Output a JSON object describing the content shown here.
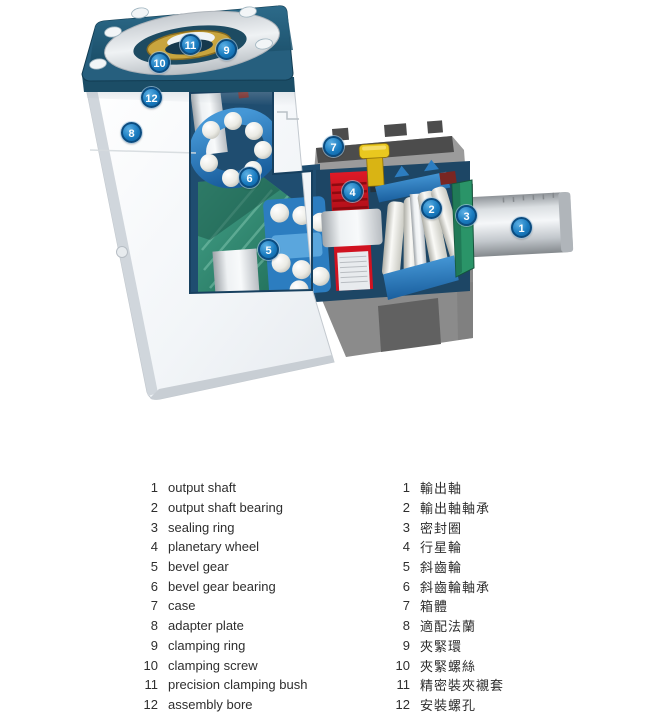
{
  "figure": {
    "type": "technical cutaway diagram",
    "subject": "right-angle planetary gearbox cross-section",
    "callouts": [
      "1",
      "2",
      "3",
      "4",
      "5",
      "6",
      "7",
      "8",
      "9",
      "10",
      "11",
      "12"
    ]
  },
  "legend": {
    "en": [
      {
        "n": "1",
        "t": "output shaft"
      },
      {
        "n": "2",
        "t": "output shaft bearing"
      },
      {
        "n": "3",
        "t": "sealing ring"
      },
      {
        "n": "4",
        "t": "planetary wheel"
      },
      {
        "n": "5",
        "t": "bevel gear"
      },
      {
        "n": "6",
        "t": "bevel gear bearing"
      },
      {
        "n": "7",
        "t": "case"
      },
      {
        "n": "8",
        "t": "adapter plate"
      },
      {
        "n": "9",
        "t": "clamping ring"
      },
      {
        "n": "10",
        "t": "clamping screw"
      },
      {
        "n": "11",
        "t": "precision clamping bush"
      },
      {
        "n": "12",
        "t": "assembly bore"
      }
    ],
    "zh": [
      {
        "n": "1",
        "t": "輸出軸"
      },
      {
        "n": "2",
        "t": "輸出軸軸承"
      },
      {
        "n": "3",
        "t": "密封圈"
      },
      {
        "n": "4",
        "t": "行星輪"
      },
      {
        "n": "5",
        "t": "斜齒輪"
      },
      {
        "n": "6",
        "t": "斜齒輪軸承"
      },
      {
        "n": "7",
        "t": "箱體"
      },
      {
        "n": "8",
        "t": "適配法蘭"
      },
      {
        "n": "9",
        "t": "夾緊環"
      },
      {
        "n": "10",
        "t": "夾緊螺絲"
      },
      {
        "n": "11",
        "t": "精密裝夾襯套"
      },
      {
        "n": "12",
        "t": "安裝螺孔"
      }
    ]
  },
  "colors": {
    "badge_blue": "#1a7cc0",
    "plate_teal": "#265f7e",
    "case_gray": "#9b9b9b",
    "case_dark": "#4c4c4c",
    "bearing_blue": "#2c7dc0",
    "gear_teal": "#2e8a74",
    "wheel_red": "#d01220",
    "seal_green": "#2a9468",
    "screw_yellow": "#e9c81f",
    "bush_gold": "#c9a53e",
    "housing_white": "#f2f5f7",
    "shaft_silver": "#cfd4d8",
    "legend_text": "#2e2e2e"
  }
}
